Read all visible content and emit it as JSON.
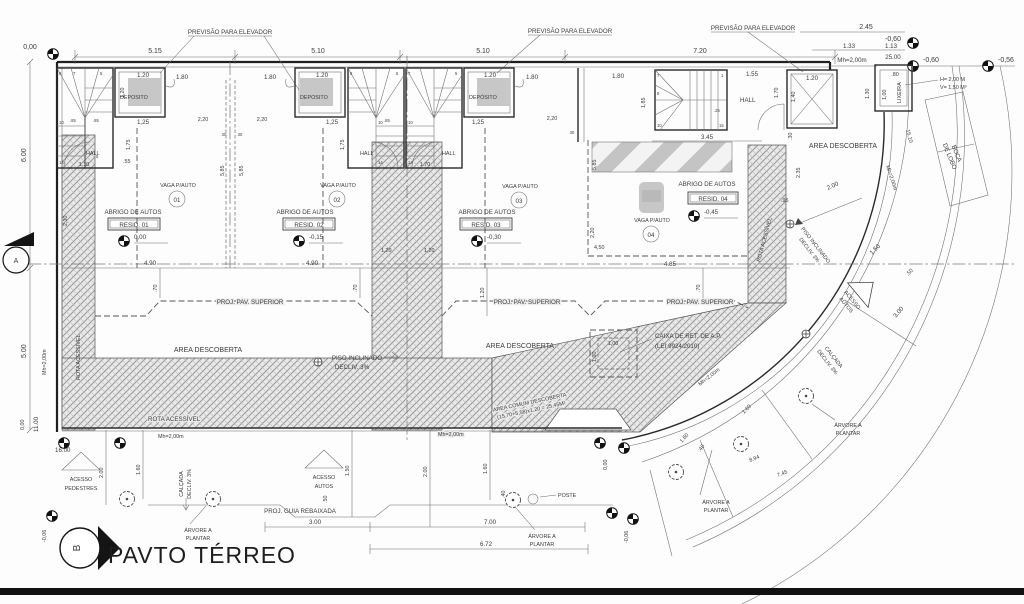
{
  "drawing": {
    "title": "PAVTO TÉRREO",
    "section_a": "A",
    "section_b": "B"
  },
  "labels": {
    "elevador": "PREVISÃO PARA ELEVADOR",
    "deposito": "DEPOSITO",
    "deposito_acc": "DEPÓSITO",
    "hall": "HALL",
    "lixeira": "LIXEIRA",
    "lix_h": "H= 2,00 M",
    "lix_v": "V= 1,50 M³",
    "vaga": "VAGA P/AUTO",
    "abrigo": "ABRIGO DE AUTOS",
    "area_descoberta": "AREA DESCOBERTA",
    "proj_pav": "PROJ. PAV. SUPERIOR",
    "piso1": "PISO INCLINADO",
    "piso2": "DECLIV. 3%",
    "caixa1": "CAIXA DE RET. DE A.P.",
    "caixa2": "(LEI 9924/2010)",
    "area_comum": "AREA COMUM DESCOBERTA",
    "area_comum2": "(15,70+5,58)x1,20 = 25,45M²",
    "rota": "ROTA ACESSÍVEL",
    "mh": "Mh=2,00m",
    "acesso": "ACESSO",
    "autos": "AUTOS",
    "pedestres": "PEDESTRES",
    "guia": "PROJ. GUIA REBAIXADA",
    "arvore1": "ÁRVORE A",
    "arvore2": "PLANTAR",
    "poste": "POSTE",
    "boca1": "BOCA",
    "boca2": "DE LOBO",
    "calcada": "CALÇADA"
  },
  "units": [
    {
      "num": "01",
      "resid": "RESID. 01",
      "level": "0,00"
    },
    {
      "num": "02",
      "resid": "RESID. 02",
      "level": "-0,15"
    },
    {
      "num": "03",
      "resid": "RESID. 03",
      "level": "-0,30"
    },
    {
      "num": "04",
      "resid": "RESID. 04",
      "level": "-0,45"
    }
  ],
  "levels": {
    "v000": "0,00",
    "v006": "-0,06",
    "v056": "-0,56",
    "v060": "-0,60"
  },
  "dims": {
    "d030": ".30",
    "d040": ".40",
    "d050": ".50",
    "d055": ".55",
    "d070": ".70",
    "d080": ".80",
    "d085": ".85",
    "d095": ".95",
    "d100": "1,00",
    "d110": "1.10",
    "d113": "1.13",
    "d120": "1.20",
    "d120c": "1,20",
    "d125": "1,25",
    "d130": "1.30",
    "d133": "1.33",
    "d140": "1,40",
    "d150": "1.50",
    "d155": "1.55",
    "d160": "1.60",
    "d170": "1.70",
    "d175": "1,75",
    "d180": "1.80",
    "d185": "1,85",
    "d200": "2.00",
    "d220": "2,20",
    "d230": "2,30",
    "d235": "2.35",
    "d245": "2.45",
    "d30": "30",
    "d300": "3.00",
    "d345": "3.45",
    "d450": "4,50",
    "d485": "4.85",
    "d490": "4.90",
    "d500": "5.00",
    "d510": "5.10",
    "d515": "5.15",
    "d585": "5,85",
    "d600": "6.00",
    "d672": "6.72",
    "d700": "7.00",
    "d720": "7.20",
    "d745": "7.45",
    "d894": "8.94",
    "d1100": "11.00",
    "d1510": "15.10",
    "d1600": "16.00",
    "d2500": "25.00"
  },
  "stair": {
    "s1": "1",
    "s5": "5",
    "s7": "7",
    "s8": "8",
    "s10": "10",
    "s14": "14",
    "s15": "15",
    "s85": ".85",
    "s25": ".25"
  }
}
